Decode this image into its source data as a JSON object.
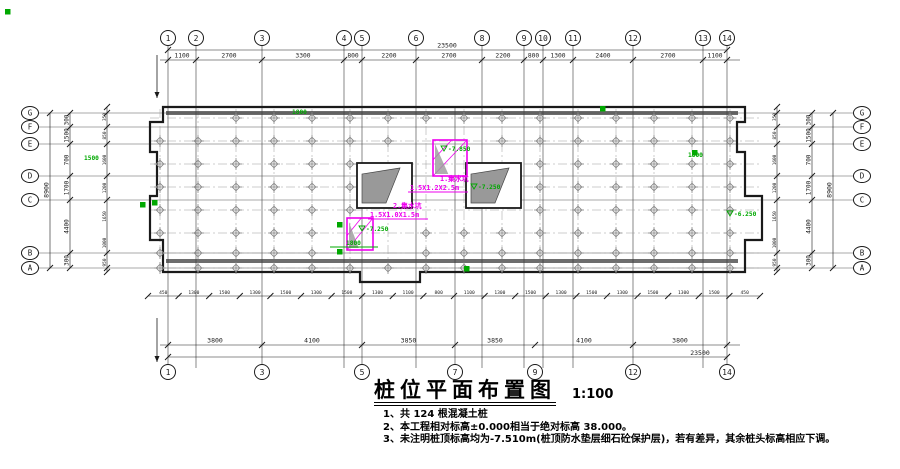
{
  "colors": {
    "line": "#1a1a1a",
    "centerline": "#9a9a9a",
    "pile": "#8a8a8a",
    "wallbar": "#3c3c3c",
    "magenta": "#ee00ee",
    "green": "#00a800",
    "stair": "#8f8f8f"
  },
  "title": {
    "text": "桩位平面布置图",
    "scale": "1:100"
  },
  "notes": [
    "1、共 124 根混凝土桩",
    "2、本工程相对标高±0.000相当于绝对标高 38.000。",
    "3、未注明桩顶标高均为-7.510m(桩顶防水垫层细石砼保护层)，若有差异，其余桩头标高相应下调。"
  ],
  "axes": {
    "top": [
      {
        "label": "1",
        "x": 168
      },
      {
        "label": "2",
        "x": 196
      },
      {
        "label": "3",
        "x": 262
      },
      {
        "label": "4",
        "x": 344
      },
      {
        "label": "5",
        "x": 362
      },
      {
        "label": "6",
        "x": 416
      },
      {
        "label": "8",
        "x": 482
      },
      {
        "label": "9",
        "x": 524
      },
      {
        "label": "10",
        "x": 543
      },
      {
        "label": "11",
        "x": 573
      },
      {
        "label": "12",
        "x": 633
      },
      {
        "label": "13",
        "x": 703
      },
      {
        "label": "14",
        "x": 727
      }
    ],
    "extra_vlines": [
      455
    ],
    "bottom": [
      {
        "label": "1",
        "x": 168
      },
      {
        "label": "3",
        "x": 262
      },
      {
        "label": "5",
        "x": 362
      },
      {
        "label": "7",
        "x": 455
      },
      {
        "label": "9",
        "x": 535
      },
      {
        "label": "12",
        "x": 633
      },
      {
        "label": "14",
        "x": 727
      }
    ],
    "left": [
      {
        "label": "G",
        "y": 113
      },
      {
        "label": "F",
        "y": 127
      },
      {
        "label": "E",
        "y": 144
      },
      {
        "label": "D",
        "y": 176
      },
      {
        "label": "C",
        "y": 200
      },
      {
        "label": "B",
        "y": 253
      },
      {
        "label": "A",
        "y": 268
      }
    ],
    "top_dims": [
      "1100",
      "2700",
      "3300",
      "800",
      "2200",
      "2700",
      "2200",
      "800",
      "1300",
      "2400",
      "2700",
      "1100"
    ],
    "top_total": "23500",
    "bottom_dims": [
      "3800",
      "4100",
      "3850",
      "3850",
      "4100",
      "3800"
    ],
    "bottom_total": "23500",
    "side_dims": [
      "300",
      "1500",
      "700",
      "1700",
      "4400",
      "300"
    ],
    "side_total": "8900",
    "side_ticks": [
      "350",
      "850",
      "1600",
      "1200",
      "1650",
      "1000",
      "950"
    ],
    "under_ticks": [
      "450",
      "1300",
      "1500",
      "1300",
      "1500",
      "1300",
      "1500",
      "1300",
      "1100",
      "800",
      "1100",
      "1300",
      "1500",
      "1300",
      "1500",
      "1300",
      "1500",
      "1300",
      "1500",
      "450"
    ]
  },
  "plan": {
    "outline_path": "M163,107 L745,107 L745,122 L737,122 L737,152 L745,152 L745,196 L762,196 L762,240 L745,240 L745,272 L420,272 L420,282 L360,282 L360,272 L163,272 L163,240 L150,240 L150,196 L157,196 L157,152 L150,152 L150,122 L163,122 Z",
    "wall_bars": [
      {
        "x": 166,
        "y": 111,
        "w": 572,
        "h": 4
      },
      {
        "x": 166,
        "y": 259,
        "w": 572,
        "h": 4
      }
    ],
    "shafts": [
      {
        "x": 357,
        "y": 163,
        "w": 55,
        "h": 45
      },
      {
        "x": 466,
        "y": 163,
        "w": 55,
        "h": 45
      }
    ],
    "stairs": [
      "M362,203 L362,174 L400,168 L386,203 Z",
      "M471,203 L471,174 L509,168 L495,203 Z"
    ],
    "pits": [
      {
        "x": 433,
        "y": 140,
        "w": 34,
        "h": 36
      },
      {
        "x": 347,
        "y": 218,
        "w": 26,
        "h": 32
      }
    ],
    "piles": {
      "cols": [
        160,
        198,
        236,
        274,
        312,
        350,
        388,
        426,
        464,
        502,
        540,
        578,
        616,
        654,
        692,
        730
      ],
      "rows": [
        118,
        141,
        164,
        187,
        210,
        233,
        253,
        268
      ],
      "skip_zones": [
        {
          "x1": 350,
          "y1": 158,
          "x2": 532,
          "y2": 212
        },
        {
          "x1": 424,
          "y1": 133,
          "x2": 476,
          "y2": 182
        },
        {
          "x1": 338,
          "y1": 213,
          "x2": 392,
          "y2": 256
        },
        {
          "x1": 150,
          "y1": 110,
          "x2": 230,
          "y2": 130
        }
      ]
    }
  },
  "annotations": {
    "magenta_texts": [
      {
        "t": "1.集水坑",
        "x": 440,
        "y": 181
      },
      {
        "t": "1.5X1.2X2.5m",
        "x": 410,
        "y": 190
      },
      {
        "t": "2.集水坑",
        "x": 393,
        "y": 208
      },
      {
        "t": "1.5X1.0X1.5m",
        "x": 370,
        "y": 217
      }
    ],
    "magenta_underlines": [
      {
        "x1": 408,
        "y1": 192,
        "x2": 468,
        "y2": 192
      },
      {
        "x1": 368,
        "y1": 219,
        "x2": 428,
        "y2": 219
      }
    ],
    "green_elevations": [
      {
        "t": "-7.850",
        "x": 448,
        "y": 151
      },
      {
        "t": "-7.250",
        "x": 478,
        "y": 189
      },
      {
        "t": "-7.250",
        "x": 366,
        "y": 231
      },
      {
        "t": "-6.250",
        "x": 734,
        "y": 216
      }
    ],
    "green_texts": [
      {
        "t": "1800",
        "x": 346,
        "y": 245
      },
      {
        "t": "1500",
        "x": 84,
        "y": 160
      },
      {
        "t": "1800",
        "x": 292,
        "y": 114
      },
      {
        "t": "1800",
        "x": 688,
        "y": 157
      }
    ],
    "green_squares": [
      [
        5,
        9
      ],
      [
        140,
        202
      ],
      [
        600,
        106
      ],
      [
        464,
        266
      ],
      [
        337,
        222
      ],
      [
        337,
        249
      ],
      [
        152,
        200
      ],
      [
        692,
        150
      ]
    ],
    "green_dim_line": {
      "x1": 330,
      "y1": 247,
      "x2": 378,
      "y2": 247
    }
  }
}
